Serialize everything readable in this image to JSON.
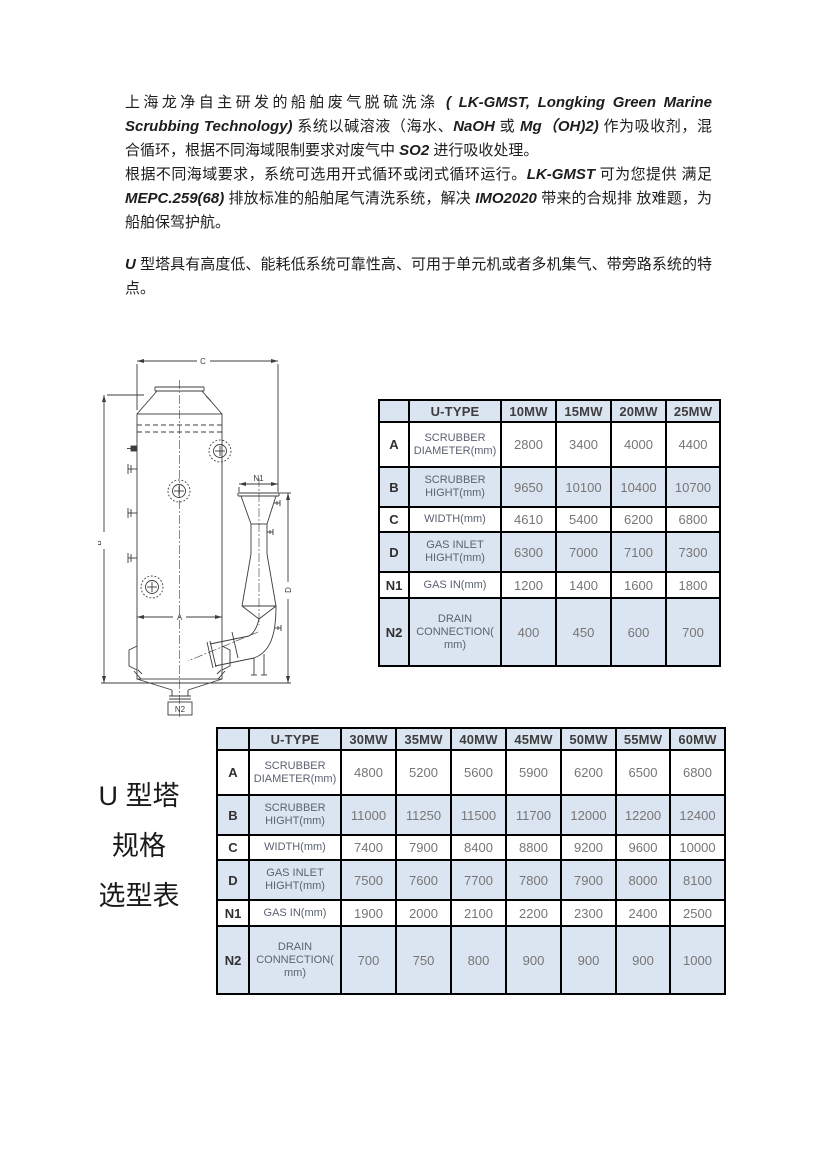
{
  "intro": {
    "paragraphs": [
      {
        "gap": false,
        "segments": [
          {
            "t": "上海龙净自主研发的船舶废气脱硫洗涤 ",
            "i": false
          },
          {
            "t": "( LK-GMST, Longking Green Marine Scrubbing Technology)",
            "i": true
          },
          {
            "t": " 系统以碱溶液（海水、",
            "i": false
          },
          {
            "t": "NaOH",
            "i": true
          },
          {
            "t": " 或 ",
            "i": false
          },
          {
            "t": "Mg（OH)2)",
            "i": true
          },
          {
            "t": " 作为吸收剂，混合循环，根据不同海域限制要求对废气中 ",
            "i": false
          },
          {
            "t": "SO2",
            "i": true
          },
          {
            "t": " 进行吸收处理。",
            "i": false
          }
        ]
      },
      {
        "gap": false,
        "segments": [
          {
            "t": "根据不同海域要求，系统可选用开式循环或闭式循环运行。",
            "i": false
          },
          {
            "t": "LK-GMST",
            "i": true
          },
          {
            "t": " 可为您提供 满足 ",
            "i": false
          },
          {
            "t": "MEPC.259(68)",
            "i": true
          },
          {
            "t": " 排放标准的船舶尾气清洗系统，解决 ",
            "i": false
          },
          {
            "t": "IMO2020",
            "i": true
          },
          {
            "t": " 带来的合规排 放难题，为船舶保驾护航。",
            "i": false
          }
        ]
      },
      {
        "gap": true,
        "segments": [
          {
            "t": "U",
            "i": true
          },
          {
            "t": " 型塔具有高度低、能耗低系统可靠性高、可用于单元机或者多机集气、带旁路系统的特点。",
            "i": false
          }
        ]
      }
    ]
  },
  "caption": {
    "lines": [
      "U 型塔",
      "规格",
      "选型表"
    ]
  },
  "drawing": {
    "labels": {
      "c": "C",
      "b": "B",
      "a": "A",
      "d": "D",
      "n1": "N1",
      "n2": "N2"
    }
  },
  "colors": {
    "table_shaded": "#dbe5f1",
    "table_border": "#000000",
    "header_text": "#3d3d3d",
    "label_text": "#5a6270",
    "value_text": "#767676",
    "body_text": "#1d1d1d"
  },
  "tables": [
    {
      "name": "u-type-selection-10-25mw",
      "header": [
        "",
        "U-TYPE",
        "10MW",
        "15MW",
        "20MW",
        "25MW"
      ],
      "rows": [
        {
          "key": "A",
          "label_lines": [
            "SCRUBBER",
            "DIAMETER(mm)"
          ],
          "values": [
            "2800",
            "3400",
            "4000",
            "4400"
          ]
        },
        {
          "key": "B",
          "label_lines": [
            "SCRUBBER",
            "HIGHT(mm)"
          ],
          "values": [
            "9650",
            "10100",
            "10400",
            "10700"
          ]
        },
        {
          "key": "C",
          "label_lines": [
            "WIDTH(mm)"
          ],
          "values": [
            "4610",
            "5400",
            "6200",
            "6800"
          ]
        },
        {
          "key": "D",
          "label_lines": [
            "GAS INLET",
            "HIGHT(mm)"
          ],
          "values": [
            "6300",
            "7000",
            "7100",
            "7300"
          ]
        },
        {
          "key": "N1",
          "label_lines": [
            "GAS IN(mm)"
          ],
          "values": [
            "1200",
            "1400",
            "1600",
            "1800"
          ]
        },
        {
          "key": "N2",
          "label_lines": [
            "DRAIN",
            "CONNECTION(",
            "mm)"
          ],
          "values": [
            "400",
            "450",
            "600",
            "700"
          ]
        }
      ]
    },
    {
      "name": "u-type-selection-30-60mw",
      "header": [
        "",
        "U-TYPE",
        "30MW",
        "35MW",
        "40MW",
        "45MW",
        "50MW",
        "55MW",
        "60MW"
      ],
      "rows": [
        {
          "key": "A",
          "label_lines": [
            "SCRUBBER",
            "DIAMETER(mm)"
          ],
          "values": [
            "4800",
            "5200",
            "5600",
            "5900",
            "6200",
            "6500",
            "6800"
          ]
        },
        {
          "key": "B",
          "label_lines": [
            "SCRUBBER",
            "HIGHT(mm)"
          ],
          "values": [
            "11000",
            "11250",
            "11500",
            "11700",
            "12000",
            "12200",
            "12400"
          ]
        },
        {
          "key": "C",
          "label_lines": [
            "WIDTH(mm)"
          ],
          "values": [
            "7400",
            "7900",
            "8400",
            "8800",
            "9200",
            "9600",
            "10000"
          ]
        },
        {
          "key": "D",
          "label_lines": [
            "GAS INLET",
            "HIGHT(mm)"
          ],
          "values": [
            "7500",
            "7600",
            "7700",
            "7800",
            "7900",
            "8000",
            "8100"
          ]
        },
        {
          "key": "N1",
          "label_lines": [
            "GAS IN(mm)"
          ],
          "values": [
            "1900",
            "2000",
            "2100",
            "2200",
            "2300",
            "2400",
            "2500"
          ]
        },
        {
          "key": "N2",
          "label_lines": [
            "DRAIN",
            "CONNECTION(",
            "mm)"
          ],
          "values": [
            "700",
            "750",
            "800",
            "900",
            "900",
            "900",
            "1000"
          ]
        }
      ]
    }
  ]
}
